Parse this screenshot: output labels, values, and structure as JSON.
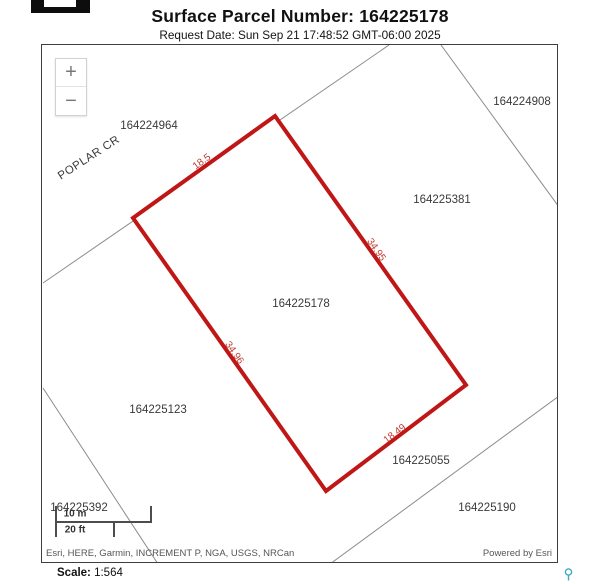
{
  "header": {
    "title": "Surface Parcel Number: 164225178",
    "request_date": "Request Date: Sun Sep 21 17:48:52 GMT-06:00 2025"
  },
  "map": {
    "zoom_in_label": "+",
    "zoom_out_label": "−",
    "road_label": "POPLAR CR",
    "selected_parcel_number": "164225178",
    "parcel_labels": [
      {
        "number": "164224964"
      },
      {
        "number": "164224908"
      },
      {
        "number": "164225381"
      },
      {
        "number": "164225178"
      },
      {
        "number": "164225123"
      },
      {
        "number": "164225055"
      },
      {
        "number": "164225190"
      },
      {
        "number": "164225392"
      }
    ],
    "dimension_labels": [
      {
        "value": "18.5"
      },
      {
        "value": "34.95"
      },
      {
        "value": "34.96"
      },
      {
        "value": "18.49"
      }
    ],
    "scale_bar": {
      "metric": "10 m",
      "imperial": "20 ft"
    },
    "attribution_left": "Esri, HERE, Garmin, INCREMENT P, NGA, USGS, NRCan",
    "attribution_right": "Powered by Esri"
  },
  "footer": {
    "scale_label": "Scale:",
    "scale_value": "1:564"
  },
  "colors": {
    "selected_parcel_outline": "#c01616",
    "boundary_line": "#8c8c8c",
    "dimension_text": "#c03a30",
    "pin_icon": "#3aacbe"
  }
}
